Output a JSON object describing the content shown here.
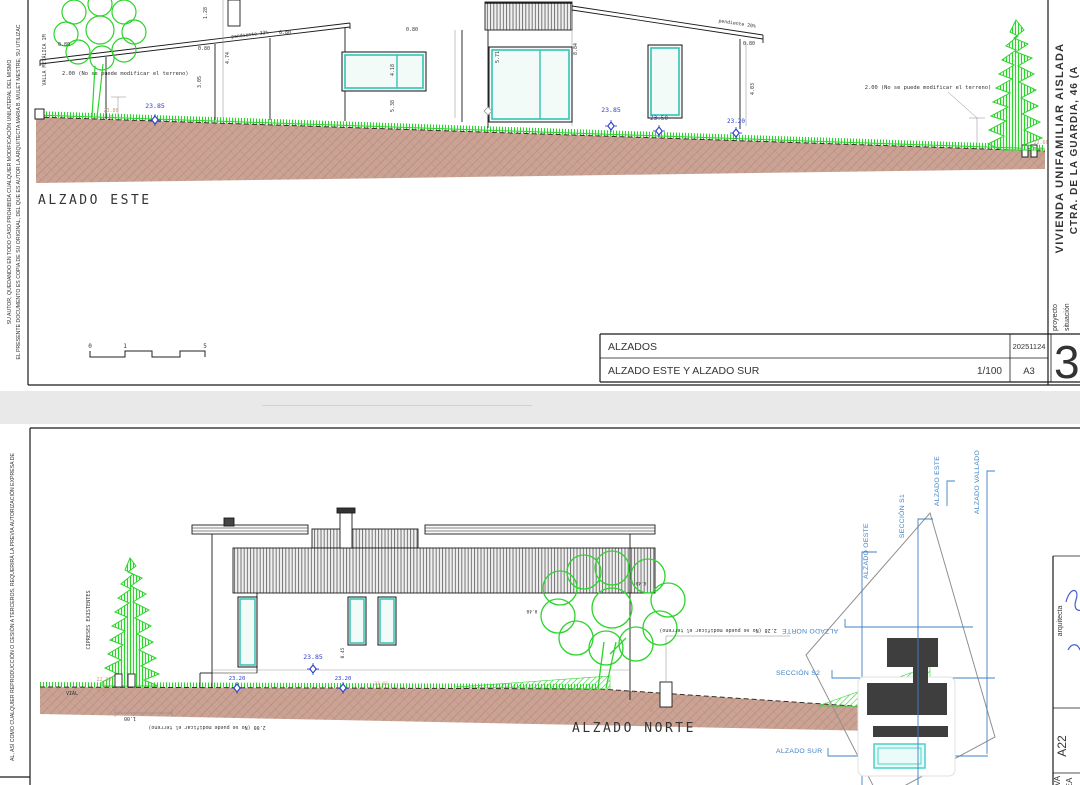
{
  "colors": {
    "terrain_fill": "#cba395",
    "terrain_hatch": "#b68a7c",
    "grass_green": "#2ed22e",
    "tree_green": "#2bd42b",
    "window_teal": "#35c3b2",
    "level_blue": "#2b3ccc",
    "level_tan": "#c79a7c",
    "keyplan_blue": "#3e82c4",
    "footprint_dark": "#3e3e3e",
    "paper": "#ffffff",
    "background": "#e9e9e9"
  },
  "sheet1": {
    "margin_left_line1": "EL PRESENTE DOCUMENTO ES COPIA DE SU ORIGINAL, DEL QUE ES AUTOR LA ARQUITECTA MARIA B. MULET MESTRE, SU UTILIZAC",
    "margin_left_line2": "SU AUTOR, QUEDANDO EN TODO CASO PROHIBIDA CUALQUIER MODIFICACIÓN UNILATERAL DEL MISMO",
    "fence_label": "VALLA METÁLICA 1M",
    "note_left": "2.00 (No se puede modificar el terreno)",
    "note_right": "2.00 (No se puede modificar el terreno)",
    "levels": {
      "l2380": "23.80",
      "l2385a": "23.85",
      "l2385b": "23.85",
      "l2350": "23.50",
      "l2320": "23.20",
      "l2260": "22.60"
    },
    "dims": {
      "d080a": "0.80",
      "d080b": "0.80",
      "d080c": "0.80",
      "d080d": "0.80",
      "d080e": "0.80",
      "d128": "1.28",
      "d305": "3.05",
      "d474": "4.74",
      "d418": "4.18",
      "d538": "5.38",
      "d571": "5.71",
      "d884": "8.84",
      "d403": "4.03",
      "pend33": "pendiente 33%",
      "pend20": "pendiente 20%"
    },
    "elevation_title": "ALZADO ESTE",
    "scalebar": {
      "s0": "0",
      "s1": "1",
      "s5": "5"
    },
    "titleblock": {
      "title": "ALZADOS",
      "subtitle": "ALZADO ESTE Y ALZADO SUR",
      "scale": "1/100",
      "date": "20251124",
      "paper": "A3",
      "sheet": "38",
      "proyecto": "proyecto",
      "situacion": "situación"
    },
    "margin_right_line1": "VIVIENDA UNIFAMILIAR AISLADA",
    "margin_right_line2": "CTRA. DE LA GUARDIA, 46 (A"
  },
  "sheet2": {
    "margin_left_line1": "AL, ASÍ COMO CUALQUIER REPRODUCCIÓN O CESIÓN A TERCEROS, REQUERIRÁ LA PREVIA AUTORIZACIÓN EXPRESA DE",
    "cypress_label": "CIPRESES EXISTENTES",
    "vial_label": "VIAL",
    "levels": {
      "l2290": "22.90",
      "l2320a": "23.20",
      "l2385": "23.85",
      "l2320b": "23.20",
      "l2303": "23.03",
      "l2248": "22.48"
    },
    "dims": {
      "d100": "1.00",
      "d040a": "0.40",
      "d040b": "0.40",
      "d045": "0.45"
    },
    "note_left": "2.00 (No se puede modificar el terreno)",
    "note_right": "2.28 (No se puede modificar el terreno)",
    "elevation_title": "ALZADO NORTE",
    "keyplan": {
      "seccion_s1": "SECCIÓN S1",
      "alzado_este": "ALZADO ESTE",
      "alzado_vallado": "ALZADO VALLADO",
      "alzado_oeste": "ALZADO OESTE",
      "alzado_norte": "ALZADO NORTE",
      "seccion_s2": "SECCIÓN S2",
      "alzado_sur": "ALZADO SUR"
    },
    "margin_right": {
      "arquitecta": "arquitecta",
      "code": "A22",
      "partial1": "VA",
      "partial2": "EA"
    }
  }
}
